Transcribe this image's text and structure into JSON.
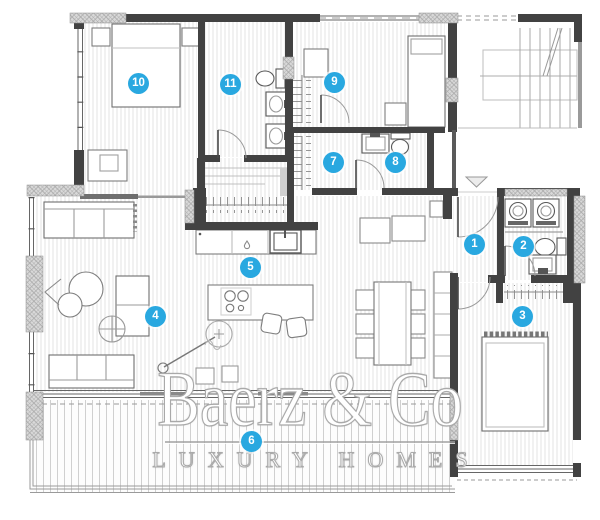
{
  "watermark": {
    "brand": "Baerz & Co",
    "tagline": "LUXURY HOMES"
  },
  "badges": [
    {
      "label": "1"
    },
    {
      "label": "2"
    },
    {
      "label": "3"
    },
    {
      "label": "4"
    },
    {
      "label": "5"
    },
    {
      "label": "6"
    },
    {
      "label": "7"
    },
    {
      "label": "8"
    },
    {
      "label": "9"
    },
    {
      "label": "10"
    },
    {
      "label": "11"
    }
  ],
  "colors": {
    "badge_blue": "#29a8e0",
    "wall_dark": "#424242",
    "hatch_gray": "#a3a3a3",
    "floor_stripe": "#dcdcdc",
    "watermark_gray": "#a9a9a9"
  }
}
